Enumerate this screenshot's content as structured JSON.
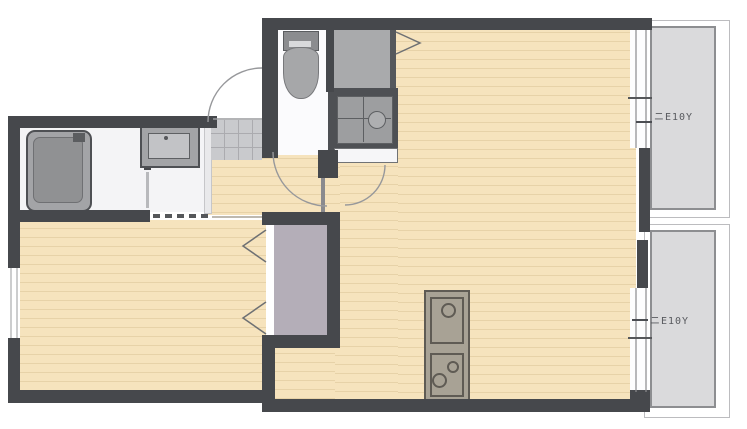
{
  "plan": {
    "balconies": [
      {
        "label": "ニE10Y"
      },
      {
        "label": "ニE10Y"
      }
    ],
    "fixtures": [
      "bathtub",
      "washbasin",
      "toilet",
      "refrigerator-space",
      "compact-kitchen-sink",
      "kitchen-counter-unit",
      "closet",
      "entrance-tile"
    ]
  },
  "colors": {
    "wall": "#46484c",
    "wall-thin": "#8a8a8e",
    "floor-wood": "#f6e3bd",
    "floor-line": "#e7d2a8",
    "balcony-floor": "#dadadc",
    "balcony-border": "#8d8e91",
    "balcony-frame-line": "#bcbcbf",
    "fixture-gray": "#a3a4a7",
    "fixture-dark": "#4e5054",
    "fixture-inner": "#909193",
    "closet-fill": "#b4aeb8",
    "nook-fill": "#a9aaac",
    "tile": "#c9cacd",
    "tile-line": "#ababaf",
    "wet-floor": "#f4f4f6",
    "arc": "#97989b",
    "label-ink": "#4b4d52"
  }
}
